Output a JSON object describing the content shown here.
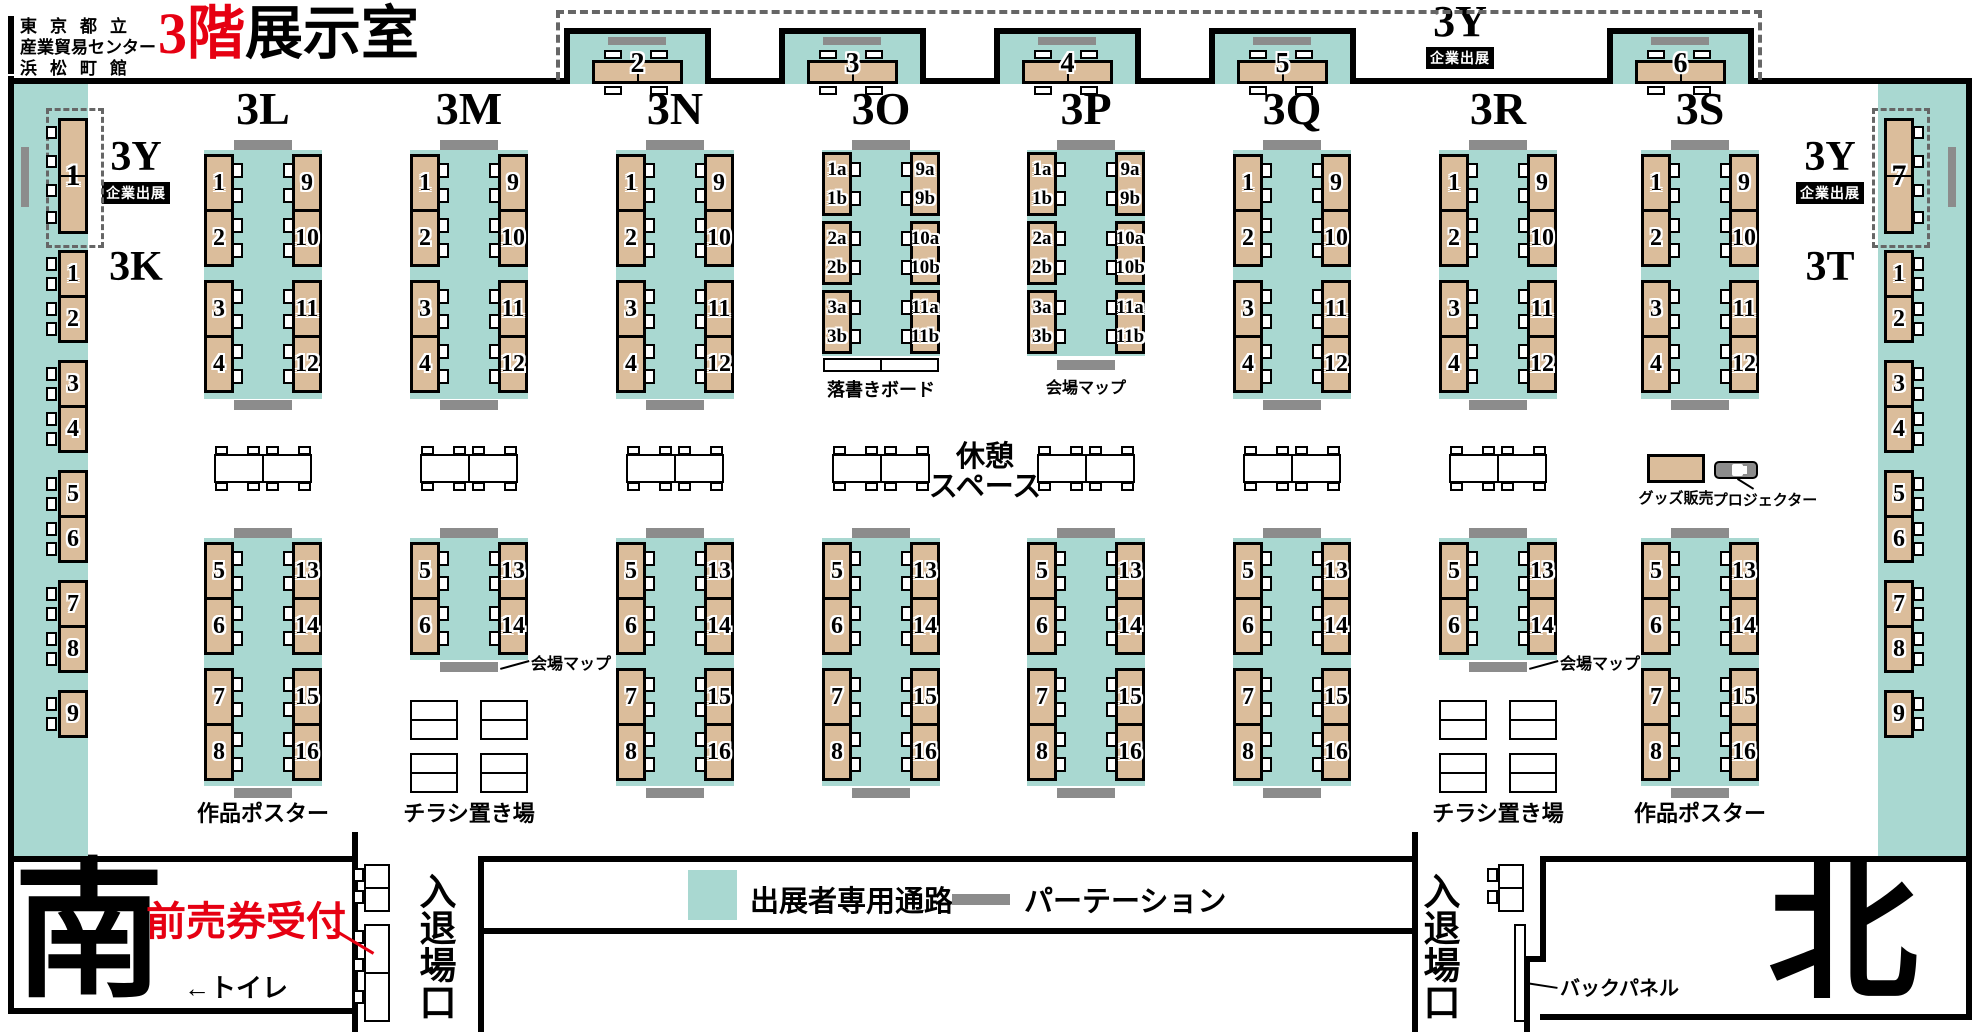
{
  "header": {
    "venue": [
      "東京都立",
      "産業貿易センター",
      "浜松町館"
    ],
    "title_red": "3階",
    "title_black": "展示室"
  },
  "top_row": {
    "y_label": "3Y",
    "y_badge": "企業出展",
    "booths": [
      "2",
      "3",
      "4",
      "5",
      "6"
    ]
  },
  "left_wing": {
    "y_label": "3Y",
    "y_badge": "企業出展",
    "y_booth": "1",
    "block": "3K",
    "booths": [
      [
        "1",
        "2"
      ],
      [
        "3",
        "4"
      ],
      [
        "5",
        "6"
      ],
      [
        "7",
        "8"
      ],
      [
        "9"
      ]
    ]
  },
  "right_wing": {
    "y_label": "3Y",
    "y_badge": "企業出展",
    "y_booth": "7",
    "block": "3T",
    "booths": [
      [
        "1",
        "2"
      ],
      [
        "3",
        "4"
      ],
      [
        "5",
        "6"
      ],
      [
        "7",
        "8"
      ],
      [
        "9"
      ]
    ],
    "screen": "スクリーン"
  },
  "islands": [
    {
      "name": "3L",
      "type": "regular",
      "top_left": [
        [
          "1",
          "2"
        ],
        [
          "3",
          "4"
        ]
      ],
      "top_right": [
        [
          "9",
          "10"
        ],
        [
          "11",
          "12"
        ]
      ],
      "bottom": "full",
      "bottom_left": [
        [
          "5",
          "6"
        ],
        [
          "7",
          "8"
        ]
      ],
      "bottom_right": [
        [
          "13",
          "14"
        ],
        [
          "15",
          "16"
        ]
      ],
      "bottom_label": "作品ポスター"
    },
    {
      "name": "3M",
      "type": "regular",
      "top_left": [
        [
          "1",
          "2"
        ],
        [
          "3",
          "4"
        ]
      ],
      "top_right": [
        [
          "9",
          "10"
        ],
        [
          "11",
          "12"
        ]
      ],
      "bottom": "short",
      "bottom_left": [
        [
          "5",
          "6"
        ]
      ],
      "bottom_right": [
        [
          "13",
          "14"
        ]
      ],
      "map_label": "会場マップ",
      "bottom_label": "チラシ置き場"
    },
    {
      "name": "3N",
      "type": "regular",
      "top_left": [
        [
          "1",
          "2"
        ],
        [
          "3",
          "4"
        ]
      ],
      "top_right": [
        [
          "9",
          "10"
        ],
        [
          "11",
          "12"
        ]
      ],
      "bottom": "full",
      "bottom_left": [
        [
          "5",
          "6"
        ],
        [
          "7",
          "8"
        ]
      ],
      "bottom_right": [
        [
          "13",
          "14"
        ],
        [
          "15",
          "16"
        ]
      ]
    },
    {
      "name": "3O",
      "type": "ab",
      "top_left": [
        [
          "1a",
          "1b"
        ],
        [
          "2a",
          "2b"
        ],
        [
          "3a",
          "3b"
        ]
      ],
      "top_right": [
        [
          "9a",
          "9b"
        ],
        [
          "10a",
          "10b"
        ],
        [
          "11a",
          "11b"
        ]
      ],
      "board_label": "落書きボード",
      "bottom": "full",
      "bottom_left": [
        [
          "5",
          "6"
        ],
        [
          "7",
          "8"
        ]
      ],
      "bottom_right": [
        [
          "13",
          "14"
        ],
        [
          "15",
          "16"
        ]
      ]
    },
    {
      "name": "3P",
      "type": "ab",
      "top_left": [
        [
          "1a",
          "1b"
        ],
        [
          "2a",
          "2b"
        ],
        [
          "3a",
          "3b"
        ]
      ],
      "top_right": [
        [
          "9a",
          "9b"
        ],
        [
          "10a",
          "10b"
        ],
        [
          "11a",
          "11b"
        ]
      ],
      "top_map_label": "会場マップ",
      "bottom": "full",
      "bottom_left": [
        [
          "5",
          "6"
        ],
        [
          "7",
          "8"
        ]
      ],
      "bottom_right": [
        [
          "13",
          "14"
        ],
        [
          "15",
          "16"
        ]
      ]
    },
    {
      "name": "3Q",
      "type": "regular",
      "top_left": [
        [
          "1",
          "2"
        ],
        [
          "3",
          "4"
        ]
      ],
      "top_right": [
        [
          "9",
          "10"
        ],
        [
          "11",
          "12"
        ]
      ],
      "bottom": "full",
      "bottom_left": [
        [
          "5",
          "6"
        ],
        [
          "7",
          "8"
        ]
      ],
      "bottom_right": [
        [
          "13",
          "14"
        ],
        [
          "15",
          "16"
        ]
      ]
    },
    {
      "name": "3R",
      "type": "regular",
      "top_left": [
        [
          "1",
          "2"
        ],
        [
          "3",
          "4"
        ]
      ],
      "top_right": [
        [
          "9",
          "10"
        ],
        [
          "11",
          "12"
        ]
      ],
      "bottom": "short",
      "bottom_left": [
        [
          "5",
          "6"
        ]
      ],
      "bottom_right": [
        [
          "13",
          "14"
        ]
      ],
      "map_label": "会場マップ",
      "bottom_label": "チラシ置き場"
    },
    {
      "name": "3S",
      "type": "regular",
      "top_left": [
        [
          "1",
          "2"
        ],
        [
          "3",
          "4"
        ]
      ],
      "top_right": [
        [
          "9",
          "10"
        ],
        [
          "11",
          "12"
        ]
      ],
      "bottom": "full",
      "bottom_left": [
        [
          "5",
          "6"
        ],
        [
          "7",
          "8"
        ]
      ],
      "bottom_right": [
        [
          "13",
          "14"
        ],
        [
          "15",
          "16"
        ]
      ],
      "bottom_label": "作品ポスター"
    }
  ],
  "rest": {
    "line1": "休憩",
    "line2": "スペース"
  },
  "goods_label": "グッズ販売",
  "projector_label": "プロジェクター",
  "legend": {
    "aisle": "出展者専用通路",
    "partition": "パーテーション"
  },
  "bottom": {
    "south": "南",
    "north": "北",
    "ticket": "前売券受付",
    "toilet": "←トイレ",
    "gate": "入退場口",
    "backpanel": "バックパネル"
  },
  "colors": {
    "aisle_teal": "#a9d8d1",
    "table_tan": "#dbbd9b",
    "partition_gray": "#8c8c8c",
    "accent_red": "#e60012"
  }
}
